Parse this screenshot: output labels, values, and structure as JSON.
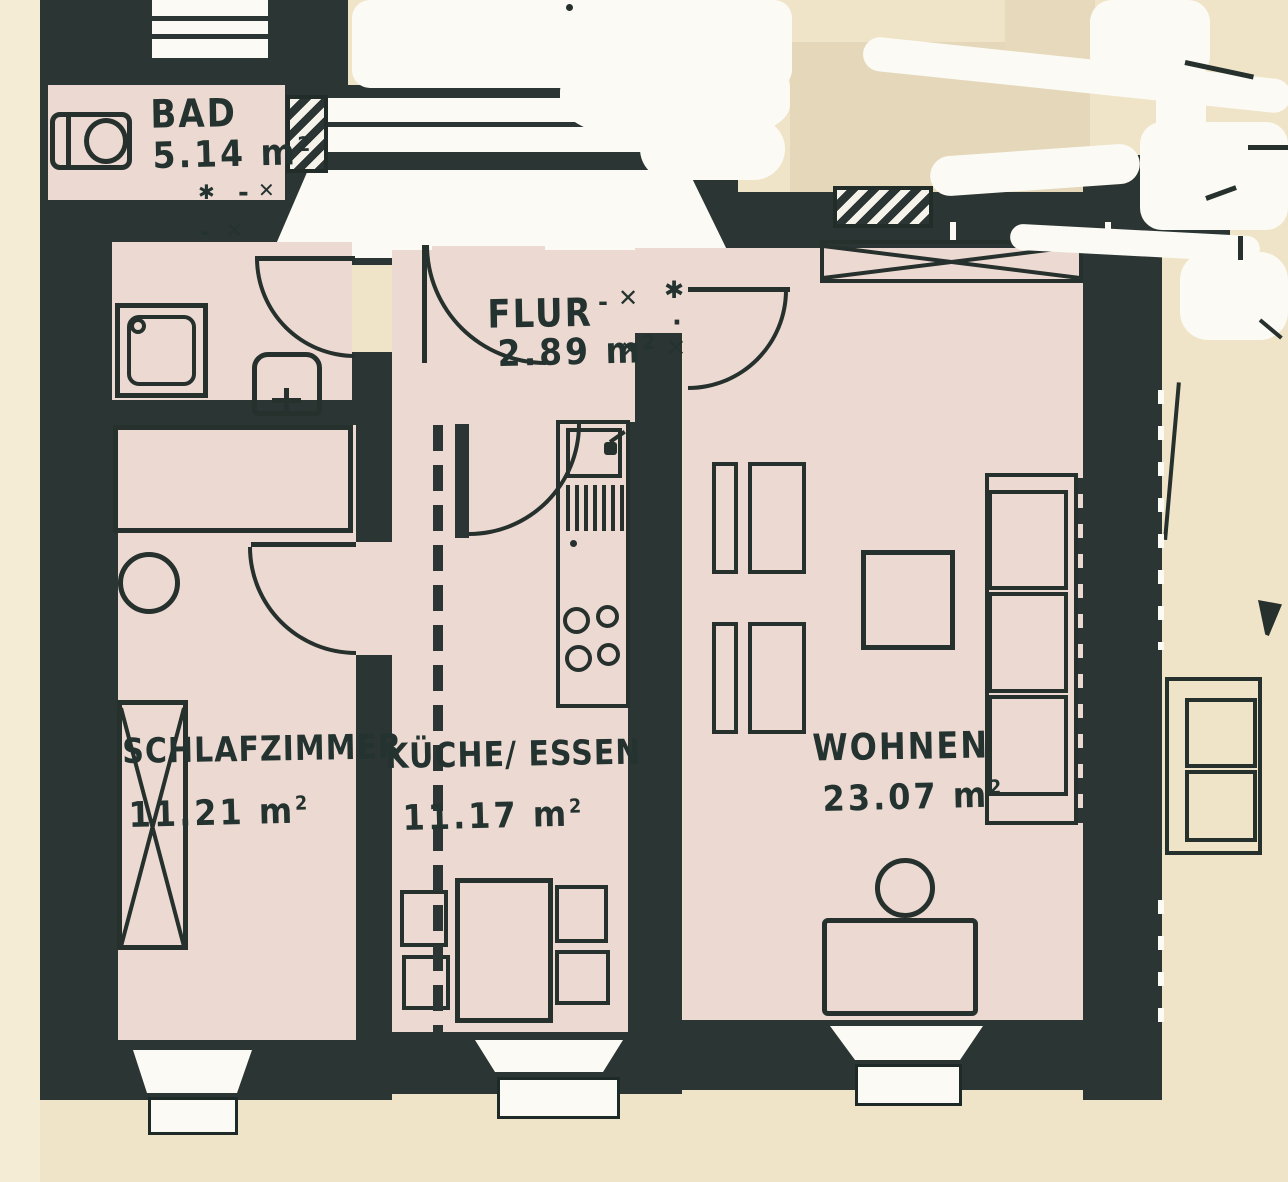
{
  "document": {
    "type": "scanned architectural floor plan",
    "language": "de"
  },
  "units": {
    "unit": " m",
    "exp": "2"
  },
  "rooms": [
    {
      "id": "bad",
      "label": "BAD",
      "area": "5.14"
    },
    {
      "id": "flur",
      "label": "FLUR",
      "area": "2.89"
    },
    {
      "id": "schlafzimmer",
      "label": "SCHLAFZIMMER",
      "area": "11.21"
    },
    {
      "id": "kueche",
      "label": "KÜCHE/ ESSEN",
      "area": "11.17"
    },
    {
      "id": "wohnen",
      "label": "WOHNEN",
      "area": "23.07"
    }
  ],
  "marks": {
    "star": "✱",
    "cross": "✕",
    "dash": "-",
    "dot": "·"
  },
  "fixtures": [
    "toilet",
    "shower-tray",
    "washbasin",
    "bed",
    "wardrobe",
    "chair-round",
    "kitchen-counter",
    "sink",
    "dish-drainer",
    "stove-4-burners",
    "dining-table",
    "dining-chairs",
    "built-in-closet",
    "armchairs",
    "coffee-table",
    "sofa",
    "desk",
    "desk-chair",
    "neighbor-sofa",
    "stair-landing",
    "windows",
    "door-swings"
  ],
  "colors": {
    "wall": "#2b3533",
    "room_floor": "#ecdad2",
    "page": "#f0e4c8",
    "paper_white": "#fbfaf4",
    "ink": "#243330"
  }
}
